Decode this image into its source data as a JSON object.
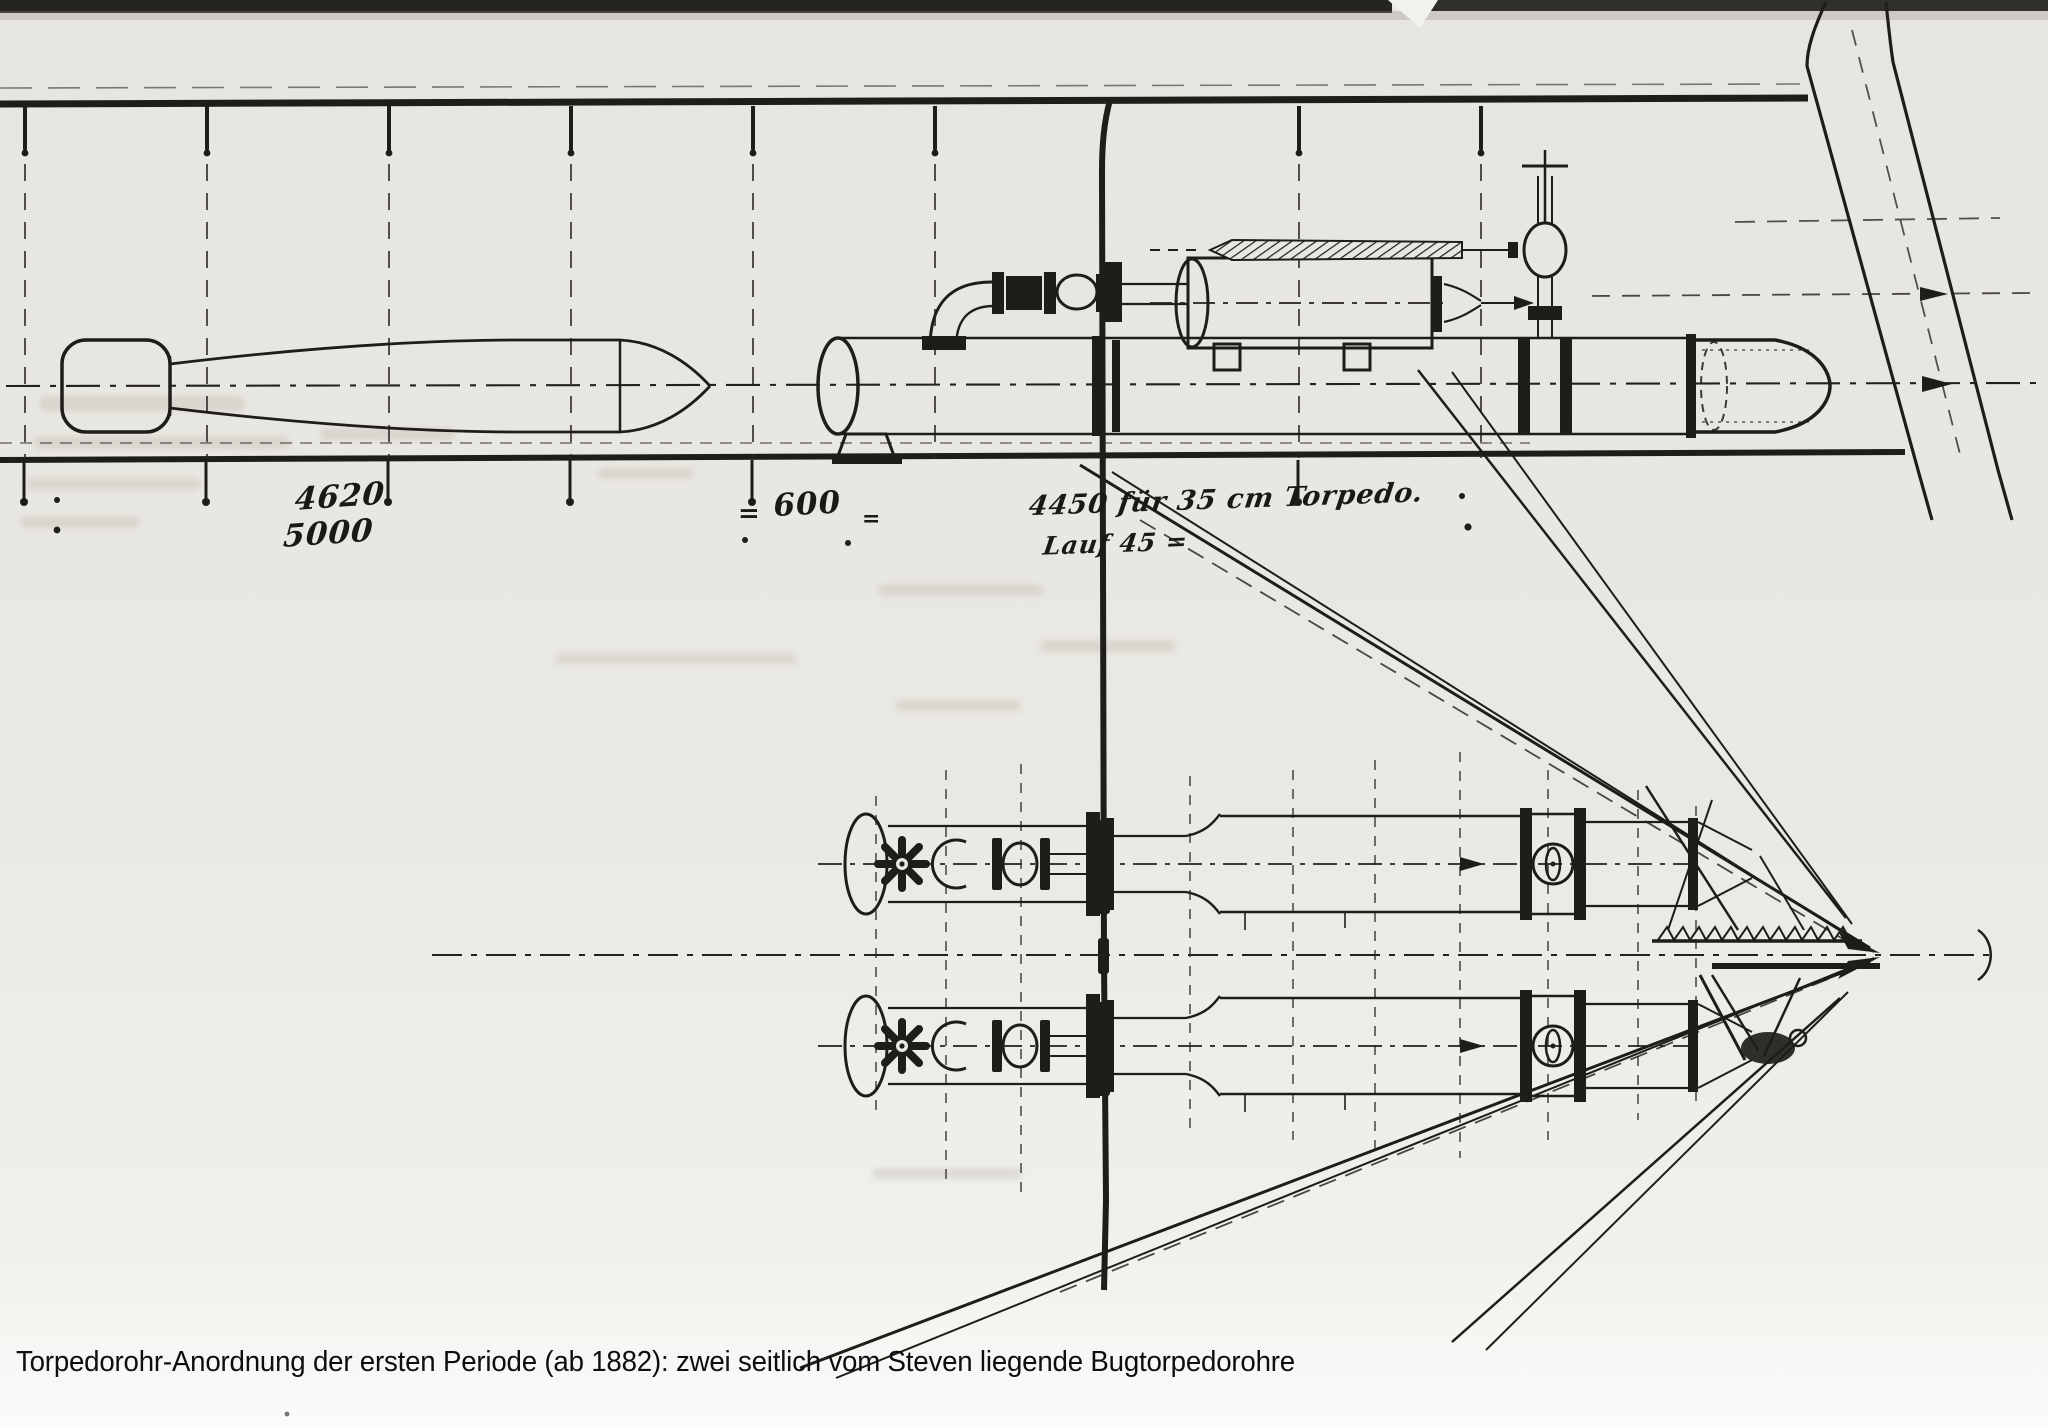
{
  "page": {
    "paper_color": "#e9e7e1",
    "ink_color": "#1f1d1a",
    "description": "Scanned historical torpedo-tube arrangement drawing, side elevation above and bow plan view below"
  },
  "caption": {
    "text": "Torpedorohr-Anordnung der ersten Periode (ab 1882): zwei seitlich vom Steven liegende Bugtorpedorohre"
  },
  "annotations": {
    "dim_upper": "4620",
    "dim_lower": "5000",
    "dim_equals_left": "=",
    "dim_600": "600",
    "dim_equals_right": "=",
    "note_torpedo": "4450 für 35 cm Torpedo.",
    "note_lauf": "Lauf  45 ="
  }
}
